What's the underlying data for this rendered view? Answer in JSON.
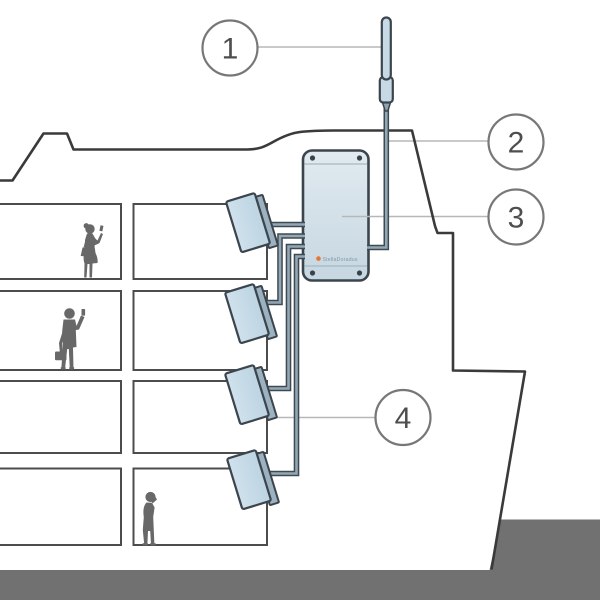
{
  "callouts": [
    {
      "number": "1"
    },
    {
      "number": "2"
    },
    {
      "number": "3"
    },
    {
      "number": "4"
    }
  ],
  "repeater": {
    "brand": "StellaDoradus"
  },
  "colors": {
    "device_fill": "#c9dce8",
    "device_fill_light": "#e1eaf0",
    "device_outline": "#3c454d",
    "panel_side": "#9db2c0",
    "cable_core": "#93a7b4",
    "cable_outline": "#3e4a52",
    "ship_outline": "#3a3a3a",
    "room_outline": "#4c4c4c",
    "water": "#717171",
    "silhouette": "#686868",
    "leader_line": "#b7b7b7",
    "callout_ring": "#777777",
    "callout_number": "#4e4e4e",
    "logo_accent": "#e8762e",
    "logo_text": "#8698a8"
  }
}
